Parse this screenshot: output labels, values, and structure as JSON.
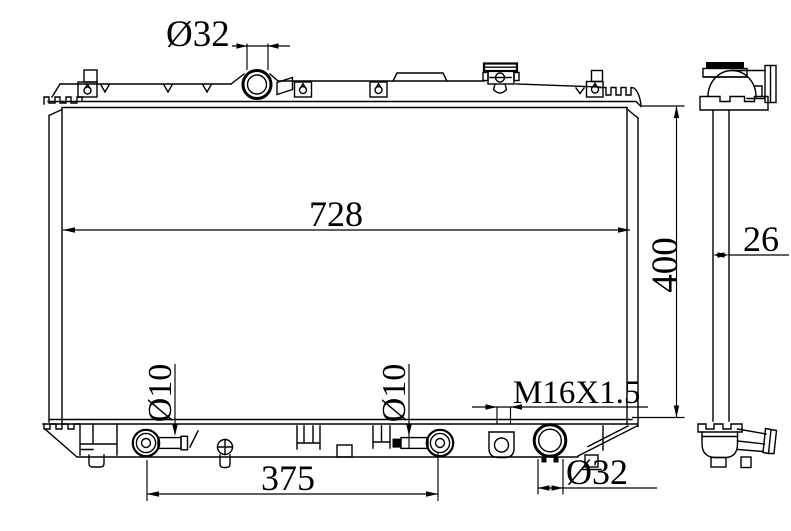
{
  "page": {
    "background": "#ffffff",
    "line_color": "#000000"
  },
  "views": {
    "front": {
      "name": "radiator front view",
      "dimensions": {
        "filler_neck_diameter": {
          "label": "Ø32",
          "value": 32
        },
        "core_width": {
          "label": "728",
          "value": 728
        },
        "core_height": {
          "label": "400",
          "value": 400
        },
        "left_pin_diameter": {
          "label": "Ø10",
          "value": 10
        },
        "right_pin_diameter": {
          "label": "Ø10",
          "value": 10
        },
        "pin_spacing": {
          "label": "375",
          "value": 375
        },
        "drain_plug_thread": {
          "label": "M16X1.5"
        },
        "outlet_diameter": {
          "label": "Ø32",
          "value": 32
        }
      }
    },
    "side": {
      "name": "radiator side view",
      "dimensions": {
        "core_thickness": {
          "label": "26",
          "value": 26
        }
      }
    }
  }
}
